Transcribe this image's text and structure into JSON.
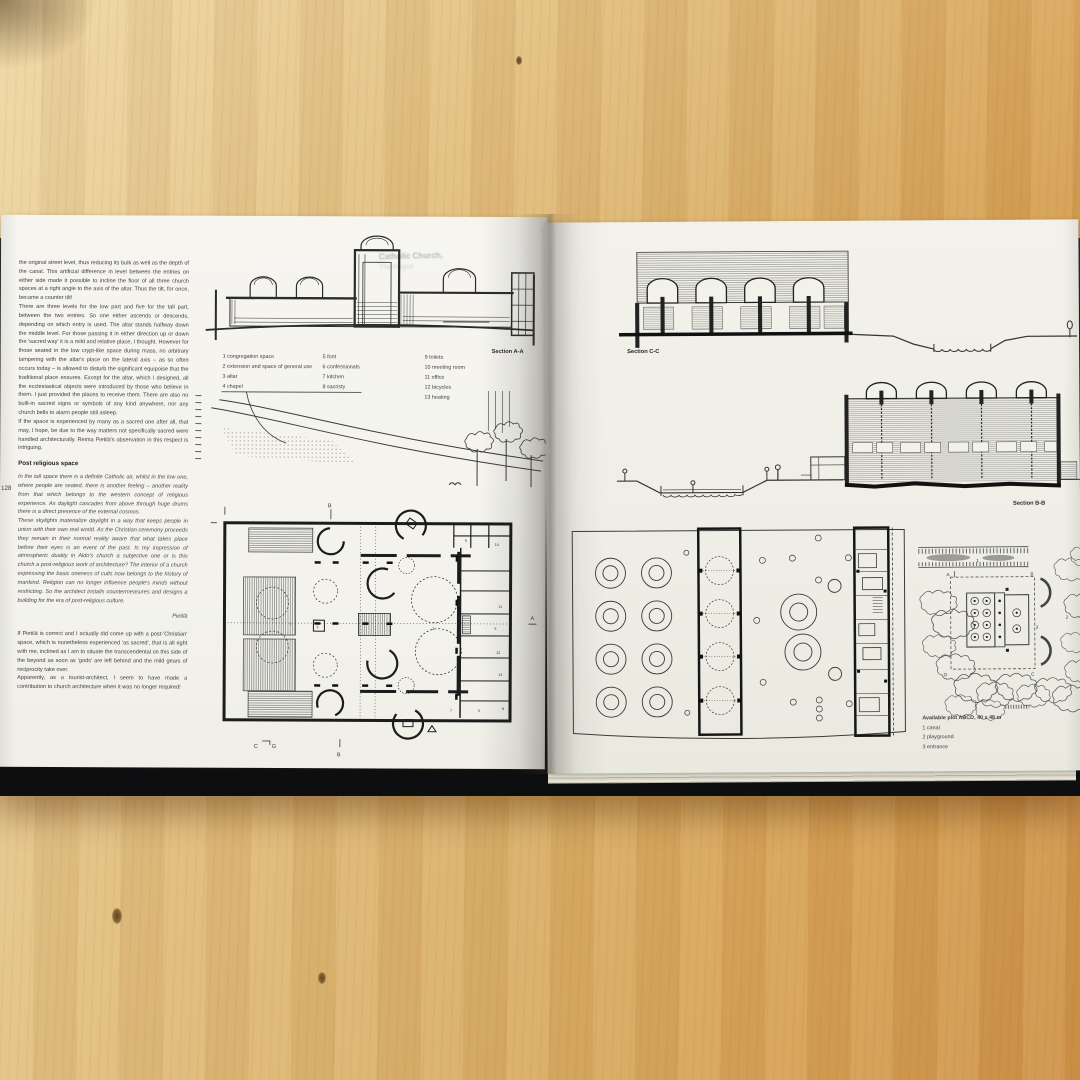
{
  "book": {
    "left_page": {
      "page_number": "128",
      "column": {
        "para1": "the original street level, thus reducing its bulk as well as the depth of the canal. This artificial difference in level between the entries on either side made it possible to incline the floor of all three church spaces at a right angle to the axis of the altar. Thus the tilt, for once, became a counter tilt!",
        "para2": "There are three levels for the low part and five for the tall part, between the two entries. So one either ascends or descends, depending on which entry is used. The altar stands halfway down the middle level. For those passing it in either direction up or down the 'sacred way' it is a mild and relative place, I thought. However for those seated in the low crypt-like space during mass, no arbitrary tampering with the altar's place on the lateral axis – as so often occurs today – is allowed to disturb the significant equipoise that the traditional place ensures. Except for the altar, which I designed, all the ecclesiastical objects were introduced by those who believe in them. I just provided the places to receive them. There are also no built-in sacred signs or symbols of any kind anywhere, nor any church bells to alarm people still asleep.",
        "para3": "If the space is experienced by many as a sacred one after all, that may, I hope, be due to the way matters not specifically sacred were handled architecturally. Reima Pietilä's observation in this respect is intriguing.",
        "heading": "Post religious space",
        "quote1": "In the tall space there is a definite Catholic air, whilst in the low one, where people are seated, there is another feeling – another reality from that which belongs to the western concept of religious experience. As daylight cascades from above through huge drums there is a direct presence of the external cosmos.",
        "quote2": "These skylights materialize daylight in a way that keeps people in union with their own real world. As the Christian ceremony proceeds they remain in their normal reality aware that what takes place before their eyes is an event of the past. Is my impression of atmospheric duality in Aldo's church a subjective one or is this church a post-religious work of architecture? The interior of a church expressing the basic oneness of cults now belongs to the history of mankind. Religion can no longer influence people's minds without restricting. So the architect installs countermeasures and designs a building for the era of post-religious culture.",
        "attribution": "Pietilä",
        "para4": "If Pietilä is correct and I actually did come up with a post-'Christian' space, which is nonetheless experienced 'as sacred', that is all right with me, inclined as I am to situate the transcendental on this side of the beyond as soon as 'gods' are left behind and the mild gears of reciprocity take over.",
        "para5": "Apparently, as a tourist-architect, I seem to have made a contribution to church architecture when it was no longer required!"
      },
      "legend": {
        "col1": [
          "1  congregation space",
          "2  extension and space of general use",
          "3  altar",
          "4  chapel"
        ],
        "col2": [
          "5  font",
          "6  confessionals",
          "7  kitchen",
          "8  sacristy"
        ],
        "col3": [
          "9  toilets",
          "10  meeting room",
          "11  office",
          "12  bicycles",
          "13  heating"
        ]
      },
      "section_a_label": "Section A-A",
      "ghost_title_line1": "Catholic Church,",
      "ghost_title_line2": "The Hague",
      "plan_markers": {
        "b_top": "B",
        "b_bottom": "B",
        "a_right": "A",
        "c": "C",
        "g": "G",
        "r1": "1",
        "r2": "2",
        "r3": "3"
      },
      "room_numbers": [
        "9",
        "10",
        "11",
        "5",
        "12",
        "13",
        "7",
        "6",
        "8"
      ]
    },
    "right_page": {
      "section_c_label": "Section C-C",
      "section_b_label": "Section B-B",
      "plot_caption": {
        "title": "Available plot ABCD, 40 x 48 m",
        "items": [
          "1  canal",
          "2  playground",
          "3  entrance"
        ]
      },
      "site_markers": {
        "a": "A",
        "b": "B",
        "c": "C",
        "d": "D",
        "n1": "1",
        "n2": "2",
        "n3": "3"
      }
    }
  }
}
